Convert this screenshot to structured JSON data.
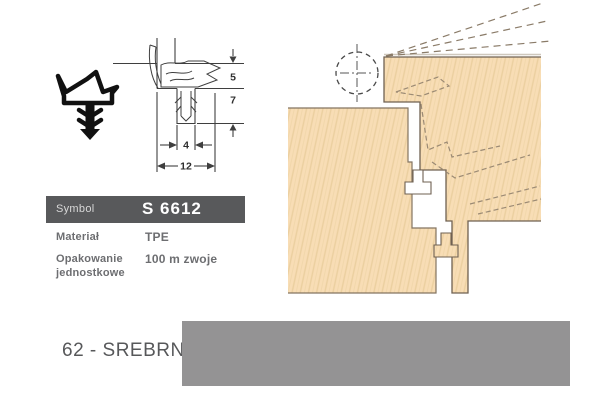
{
  "spec_table": {
    "header": {
      "label": "Symbol",
      "value": "S 6612"
    },
    "material": {
      "label": "Materiał",
      "value": "TPE"
    },
    "packaging": {
      "label_line1": "Opakowanie",
      "label_line2": "jednostkowe",
      "value": "100 m zwoje"
    }
  },
  "technical_drawing": {
    "dimensions": {
      "rebate_height": "5",
      "groove_depth": "7",
      "groove_width": "4",
      "overall_width": "12"
    }
  },
  "color_variant": {
    "label": "62 - SREBRNY",
    "swatch_color": "#949394"
  },
  "icons": {
    "seal_profile_icon": "seal-cross-section-glyph",
    "hinge_axis_icon": "dashed-circle-with-centerline"
  },
  "colors": {
    "header_bg": "#58595b",
    "table_text": "#6d6e71",
    "wood_fill": "#f8ddb5",
    "wood_grain": "#ebcf9f",
    "wood_outline": "#6f6152",
    "drawing_line": "#3f3f3f",
    "swatch_silver": "#949394"
  }
}
